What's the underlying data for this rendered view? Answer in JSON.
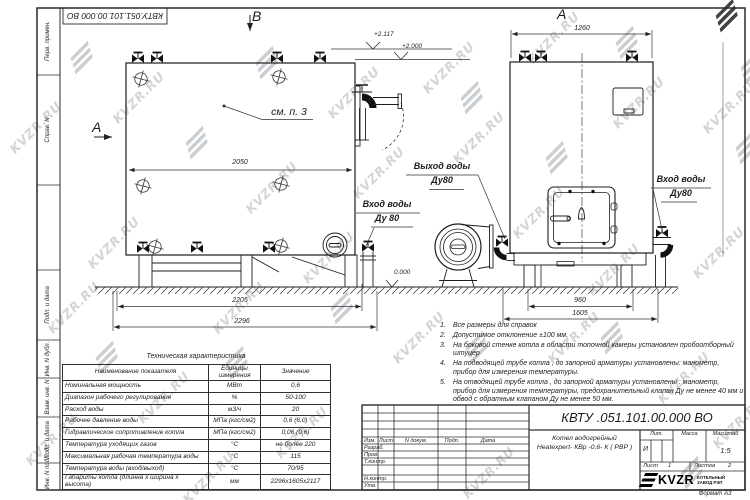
{
  "watermark": {
    "text": "KVZR.RU"
  },
  "sheet": {
    "top_doc_number": "КВТУ.051.101.00.000 ВО",
    "format_label": "Формат   А3",
    "left_strip": {
      "box1": "Перв. примен.",
      "box2": "Справ. N",
      "box3": "Подп. и дата",
      "box4": "Инв. N дубл.",
      "box5": "Взам. инв. N",
      "box6": "Подп. и дата",
      "box7": "Инв. N подл."
    }
  },
  "drawing": {
    "view_b_label": "В",
    "view_a_side_label": "А",
    "view_a_front_label": "А",
    "callout_see_item": "см. п. 3",
    "elev_top": "+2.117",
    "elev_mid": "+2.000",
    "elev_zero": "0.000",
    "dim_2050": "2050",
    "dim_2205": "2205",
    "dim_2296": "2296",
    "dim_1260": "1260",
    "dim_960": "960",
    "dim_1605": "1605",
    "label_outlet_line1": "Выход воды",
    "label_outlet_line2": "Ду80",
    "label_inlet_left_line1": "Вход воды",
    "label_inlet_left_line2": "Ду 80",
    "label_inlet_right_line1": "Вход воды",
    "label_inlet_right_line2": "Ду80"
  },
  "notes": {
    "items": [
      {
        "num": "1.",
        "text": "Все размеры для справок"
      },
      {
        "num": "2.",
        "text": "Допустимое отклонение  ±100 мм."
      },
      {
        "num": "3.",
        "text": "На боковой стенке котла в области топочной камеры установлен пробоотборный штуцер"
      },
      {
        "num": "4.",
        "text": "На  подводящей трубе котла , до запорной арматуры установлены:  манометр, прибор для измерения температуры."
      },
      {
        "num": "5.",
        "text": "На отводящей трубе котла , до запорной арматуры установлены : манометр, прибор для измерения температуры, предохранительный клапан  Ду не менее  40 мм и обвод с обратным клапаном  Ду не менее  50 мм."
      }
    ]
  },
  "tech_table": {
    "title": "Техническая характеристика",
    "col_name": "Наименование показателя",
    "col_units": "Единицы измерения",
    "col_value": "Значение",
    "rows": [
      {
        "name": "Номинальная мощность",
        "units": "МВт",
        "value": "0,6"
      },
      {
        "name": "Диапазон рабочего регулирования",
        "units": "%",
        "value": "50-100"
      },
      {
        "name": "Расход воды",
        "units": "м3/ч",
        "value": "20"
      },
      {
        "name": "Рабочее давление воды",
        "units": "МПа (кгс/см2)",
        "value": "0,6 (6,0)"
      },
      {
        "name": "Гидравлическое сопротивление котла",
        "units": "МПа (кгс/см2)",
        "value": "0,06 (0,6)"
      },
      {
        "name": "Температура уходящих газов",
        "units": "°С",
        "value": "не более 220"
      },
      {
        "name": "Максимальная рабочая температура воды",
        "units": "°С",
        "value": "115"
      },
      {
        "name": "Температура воды (вход/выход)",
        "units": "°С",
        "value": "70/95"
      },
      {
        "name": "Габариты котла (длинна х ширина х высота)",
        "units": "мм",
        "value": "2296х1605х2117"
      }
    ]
  },
  "title_block": {
    "doc_number": "КВТУ .051.101.00.000  ВО",
    "product_line1": "Котел водогрейный",
    "product_line2": "Heatexpert- КВр -0,6- К ( РВР )",
    "col_izm": "Изм.",
    "col_list": "Лист",
    "col_doc": "N докум.",
    "col_podp": "Подп.",
    "col_data": "Дата",
    "row_razrab": "Разраб.",
    "row_prov": "Пров.",
    "row_tkontr": "Т.контр.",
    "row_nkontr": "Н.контр.",
    "row_utv": "Утв.",
    "lit_label": "Лит.",
    "mass_label": "Масса",
    "scale_label": "Масштаб",
    "lit_value": "И",
    "scale_value": "1:5",
    "sheet_label": "Лист",
    "sheet_value": "1",
    "sheets_label": "Листов",
    "sheets_value": "2",
    "logo_text": "KVZR",
    "logo_caption1": "КОТЕЛЬНЫЙ",
    "logo_caption2": "ЗАВОД РЭП"
  }
}
